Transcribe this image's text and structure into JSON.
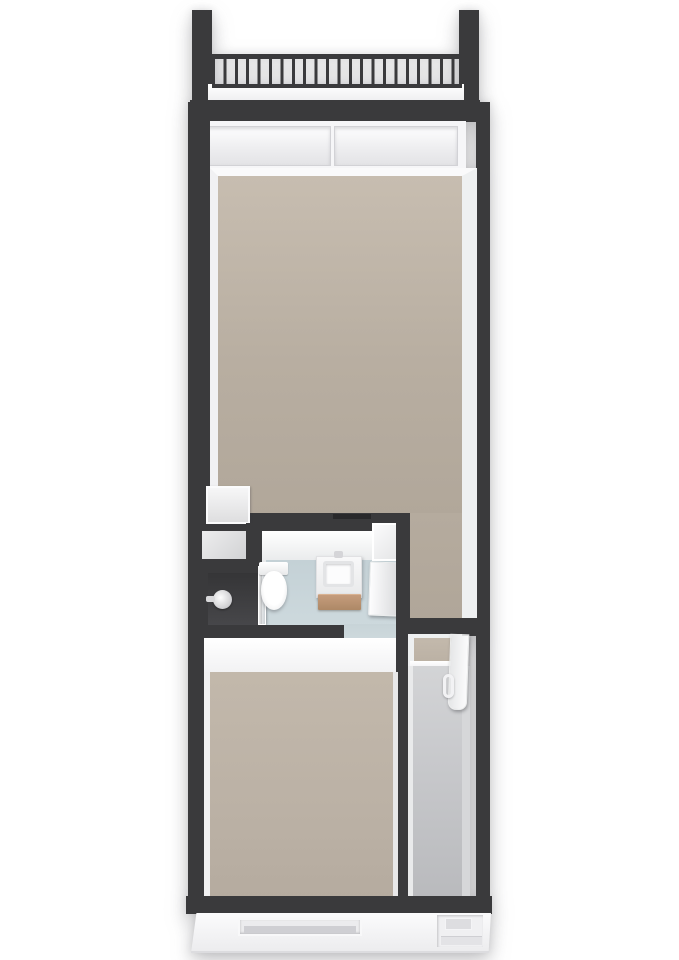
{
  "scene": {
    "kind": "3d-floorplan-render",
    "orientation": "top-down axonometric, narrow deep dwelling",
    "background": "#ffffff"
  },
  "palette": {
    "wall_dark": "#3a3a3c",
    "floor_beige": "#b8aea1",
    "floor_beige_light": "#c7bdb0",
    "floor_beige_lower": "#c2b8ab",
    "floor_blue": "#c4d1d6",
    "floor_gray": "#c8c9cc",
    "shower_dark": "#47474a",
    "wood": "#c59c7c",
    "white_wall": "#f4f4f5",
    "background": "#ffffff"
  },
  "areas": [
    {
      "name": "balcony",
      "features": [
        "railing with vertical bars",
        "two dark side pillars",
        "light floor strip"
      ]
    },
    {
      "name": "main-room",
      "floor": "beige",
      "features": [
        "full-width rear window with two panels",
        "white storage cabinet at bathroom wall"
      ]
    },
    {
      "name": "bathroom",
      "floor": "light-blue",
      "features": [
        "shower with dark floor and glass panel",
        "wall shower head",
        "toilet",
        "vanity with wooden drawer",
        "open white door"
      ]
    },
    {
      "name": "utility-nook",
      "floor": "light-gray"
    },
    {
      "name": "hallway",
      "floor": "gray",
      "features": [
        "doorway with step and beige threshold",
        "open white door with handle"
      ]
    },
    {
      "name": "lower-room",
      "floor": "beige",
      "features": [
        "open white door from bathroom zone"
      ]
    },
    {
      "name": "street-facade",
      "features": [
        "recessed front window",
        "recessed front door with step"
      ]
    }
  ]
}
